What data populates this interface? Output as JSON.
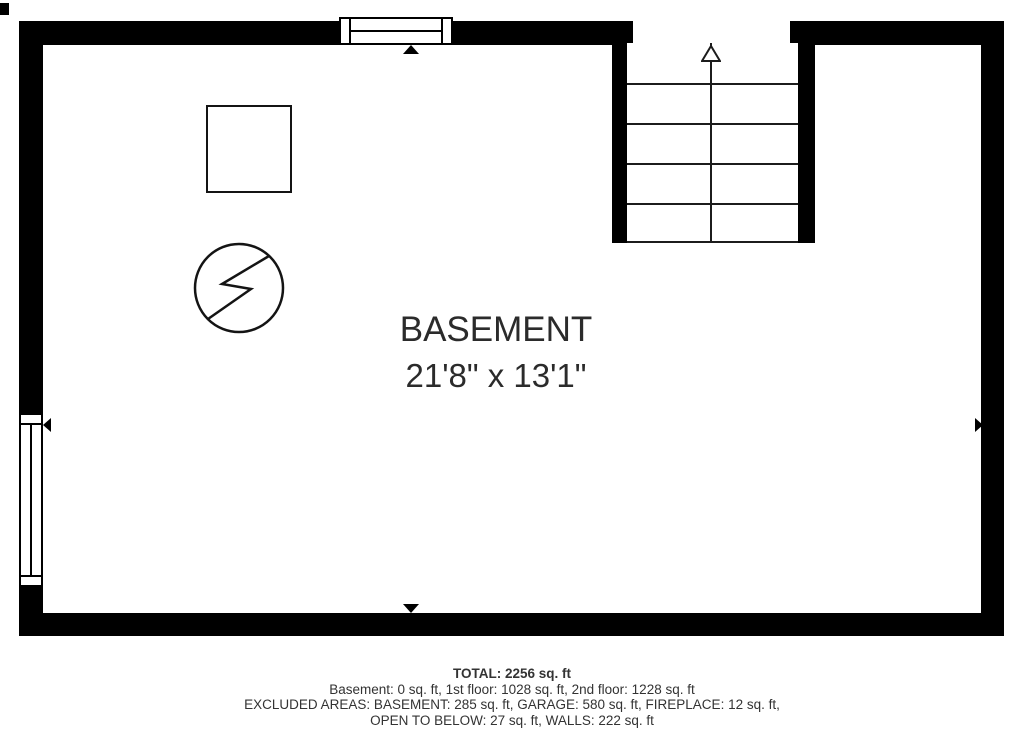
{
  "plan": {
    "room": {
      "label": "BASEMENT",
      "dimensions": "21'8\" x 13'1\""
    },
    "symbols": {
      "stairs": "staircase-going-up",
      "stair_arrow": "up-direction-arrow",
      "square": "furnace-utility-square",
      "circle_bolt": "water-heater-circle-with-bolt",
      "dimension_arrows": [
        "up",
        "down",
        "left",
        "right"
      ]
    },
    "colors": {
      "wall": "#000000",
      "line": "#1c1c1c",
      "text": "#2b2b2b",
      "background": "#ffffff"
    }
  },
  "summary": {
    "total": "TOTAL: 2256 sq. ft",
    "floors": "Basement: 0 sq. ft, 1st floor: 1028 sq. ft, 2nd floor: 1228 sq. ft",
    "excluded_1": "EXCLUDED AREAS: BASEMENT: 285 sq. ft, GARAGE: 580 sq. ft, FIREPLACE: 12 sq. ft,",
    "excluded_2": "OPEN TO BELOW: 27 sq. ft, WALLS: 222 sq. ft"
  }
}
